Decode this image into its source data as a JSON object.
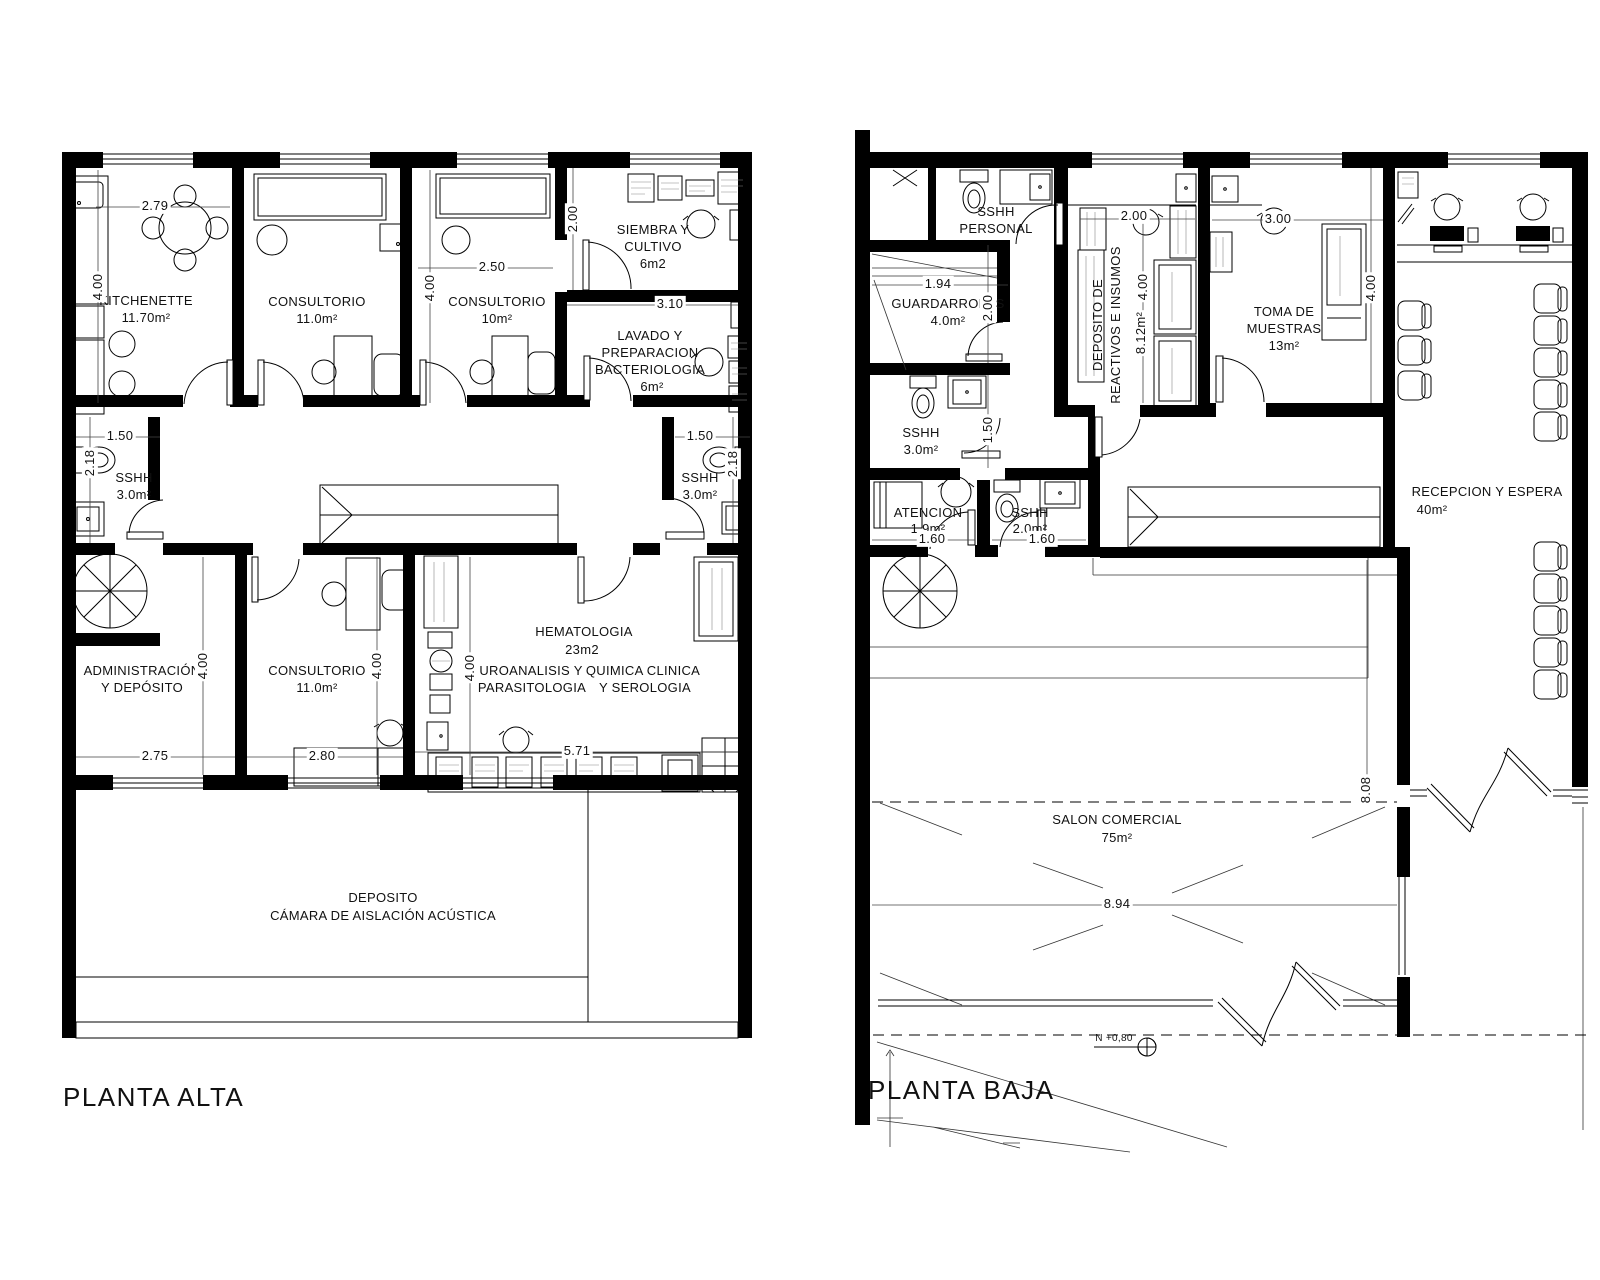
{
  "pa": {
    "title": "PLANTA ALTA",
    "rooms": {
      "kitchenette": {
        "n1": "KITCHENETTE",
        "a": "11.70m²"
      },
      "consultorio1": {
        "n1": "CONSULTORIO",
        "a": "11.0m²"
      },
      "consultorio2": {
        "n1": "CONSULTORIO",
        "a": "10m²"
      },
      "siembra": {
        "n1": "SIEMBRA Y",
        "n2": "CULTIVO",
        "a": "6m2"
      },
      "lavado": {
        "n1": "LAVADO Y",
        "n2": "PREPARACION",
        "n3": "BACTERIOLOGIA",
        "a": "6m²"
      },
      "sshh_izq": {
        "n1": "SSHH",
        "a": "3.0m²"
      },
      "sshh_der": {
        "n1": "SSHH",
        "a": "3.0m²"
      },
      "administracion": {
        "n1": "ADMINISTRACIÓN",
        "n2": "Y DEPÓSITO"
      },
      "consultorio3": {
        "n1": "CONSULTORIO",
        "a": "11.0m²"
      },
      "hematologia": {
        "n1": "HEMATOLOGIA",
        "a": "23m2"
      },
      "uroanalisis": {
        "n1": "UROANALISIS Y",
        "n2": "PARASITOLOGIA"
      },
      "quimica": {
        "n1": "QUIMICA CLINICA",
        "n2": "Y SEROLOGIA"
      },
      "deposito": {
        "n1": "DEPOSITO",
        "n2": "CÁMARA DE AISLACIÓN ACÚSTICA"
      }
    },
    "dims": {
      "k_w": "2.79",
      "k_h": "4.00",
      "c2_w": "2.50",
      "c2_h": "4.00",
      "si_h": "2.00",
      "la_w": "3.10",
      "sl_w": "1.50",
      "sl_h": "2.18",
      "sr_w": "1.50",
      "sr_h": "2.18",
      "ad_h": "4.00",
      "c3_h": "4.00",
      "he_h": "4.00",
      "ad_w": "2.75",
      "c3_w": "2.80",
      "he_w": "5.71"
    }
  },
  "pb": {
    "title": "PLANTA BAJA",
    "level": "N +0,80",
    "rooms": {
      "sshh_personal": {
        "n1": "SSHH",
        "n2": "PERSONAL"
      },
      "guardarropas": {
        "n1": "GUARDARROPAS",
        "a": "4.0m²"
      },
      "sshh3": {
        "n1": "SSHH",
        "a": "3.0m²"
      },
      "reactivos": {
        "n1": "DEPOSITO DE",
        "n2": "REACTIVOS E INSUMOS",
        "a": "8.12m²"
      },
      "toma": {
        "n1": "TOMA DE",
        "n2": "MUESTRAS",
        "a": "13m²"
      },
      "recepcion": {
        "n1": "RECEPCION Y ESPERA",
        "a": "40m²"
      },
      "atencion": {
        "n1": "ATENCION",
        "a": "1.9m²"
      },
      "sshh2": {
        "n1": "SSHH",
        "a": "2.0m²"
      },
      "salon": {
        "n1": "SALON COMERCIAL",
        "a": "75m²"
      }
    },
    "dims": {
      "gu_w": "1.94",
      "gu_h": "2.00",
      "re_w": "2.00",
      "re_h": "4.00",
      "to_w": "3.00",
      "to_h": "4.00",
      "s3_h": "1.50",
      "at_w": "1.60",
      "s2_w": "1.60",
      "sa_w": "8.94",
      "sa_h": "8.08"
    }
  }
}
